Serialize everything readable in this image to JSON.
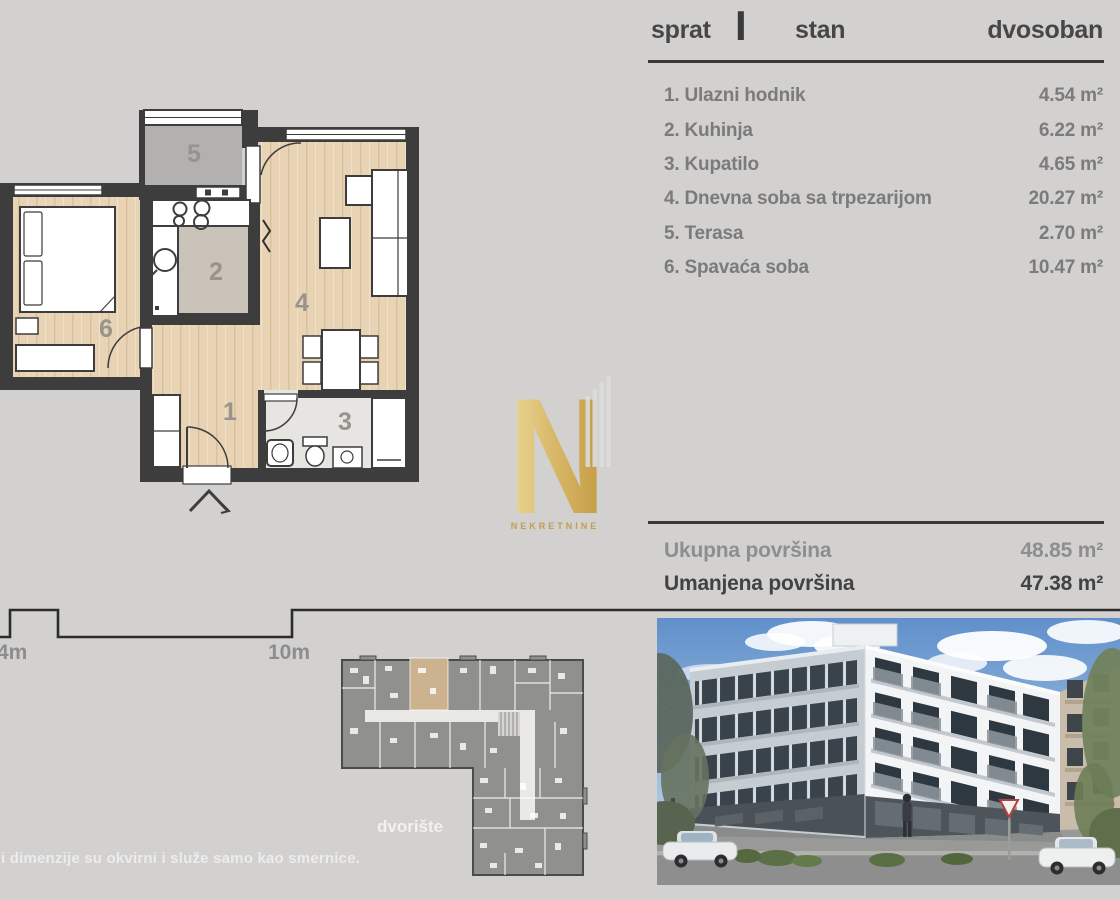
{
  "panel": {
    "floor_label": "sprat",
    "floor_value": "I",
    "unit_label": "stan",
    "unit_type": "dvosoban",
    "rooms": [
      {
        "name": "1. Ulazni hodnik",
        "area": "4.54 m²"
      },
      {
        "name": "2. Kuhinja",
        "area": "6.22 m²"
      },
      {
        "name": "3. Kupatilo",
        "area": "4.65 m²"
      },
      {
        "name": "4. Dnevna soba sa trpezarijom",
        "area": "20.27 m²"
      },
      {
        "name": "5. Terasa",
        "area": "2.70 m²"
      },
      {
        "name": "6. Spavaća soba",
        "area": "10.47 m²"
      }
    ],
    "totals": {
      "gross_label": "Ukupna površina",
      "gross_value": "48.85 m²",
      "net_label": "Umanjena površina",
      "net_value": "47.38 m²"
    }
  },
  "floor_plan": {
    "labels": {
      "hall": "1",
      "kitchen": "2",
      "bath": "3",
      "living": "4",
      "terrace": "5",
      "bedroom": "6"
    }
  },
  "scale_bar": {
    "left_label": "4m",
    "right_label": "10m"
  },
  "site_plan": {
    "caption": "dvorište"
  },
  "logo": {
    "letter": "N",
    "caption": "NEKRETNINE"
  },
  "footer": {
    "disclaimer": "i dimenzije su okvirni i služe samo kao smernice."
  },
  "colors": {
    "background": "#d2d1d0",
    "wall": "#3d3d3d",
    "wood": "#e8d3b4",
    "gold": "#d9b96a",
    "text_dark": "#454545",
    "text_muted": "#7b7b7b",
    "highlight_unit": "#cdb290"
  }
}
